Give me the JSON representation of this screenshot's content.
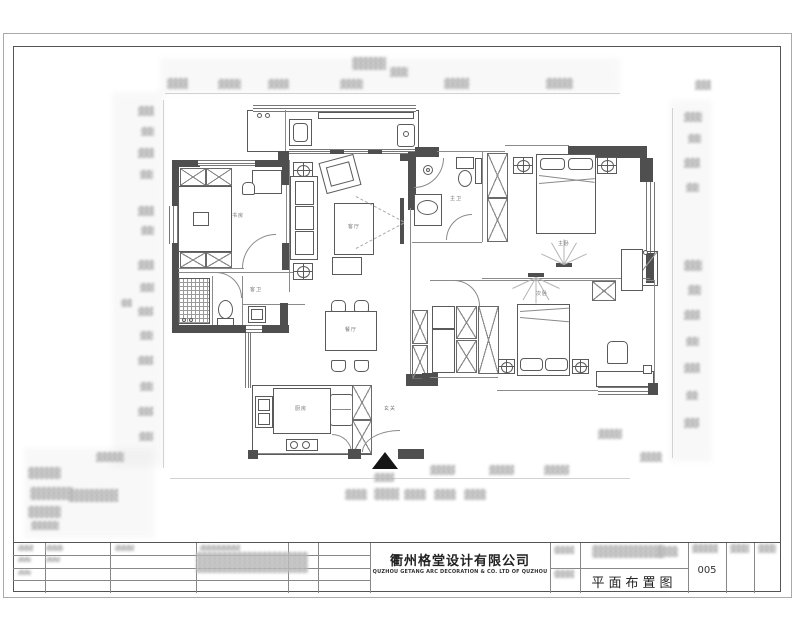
{
  "title_block": {
    "company_name": "衢州格堂设计有限公司",
    "company_name_en": "QUZHOU GETANG ARC DECORATION & CO. LTD OF QUZHOU",
    "drawing_title_label": "平面布置图",
    "drawing_number": "005"
  },
  "plan": {
    "rooms": {
      "living": "客厅",
      "dining": "餐厅",
      "kitchen": "厨房",
      "entry": "玄关",
      "master_bedroom": "主卧",
      "bedroom2": "次卧",
      "study": "书房",
      "master_bath": "主卫",
      "bath2": "客卫"
    }
  },
  "colors": {
    "wall": "#4f4f4f",
    "line": "#5a5a5a",
    "arrow": "#151515"
  }
}
